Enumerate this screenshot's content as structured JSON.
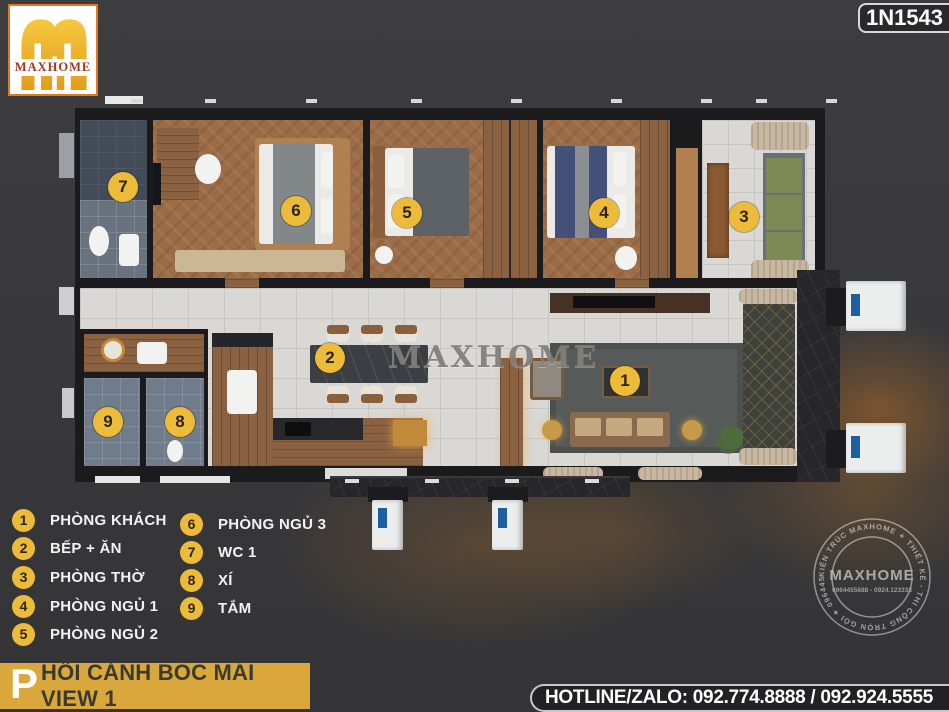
{
  "logo": {
    "text": "MAXHOME"
  },
  "badge": {
    "id": "1N1543"
  },
  "watermark": {
    "text": "MAXHOME"
  },
  "legend": {
    "items": [
      {
        "num": "1",
        "label": "PHÒNG KHÁCH"
      },
      {
        "num": "2",
        "label": "BẾP + ĂN"
      },
      {
        "num": "3",
        "label": "PHÒNG THỜ"
      },
      {
        "num": "4",
        "label": "PHÒNG NGỦ 1"
      },
      {
        "num": "5",
        "label": "PHÒNG NGỦ 2"
      },
      {
        "num": "6",
        "label": "PHÒNG NGỦ 3"
      },
      {
        "num": "7",
        "label": "WC 1"
      },
      {
        "num": "8",
        "label": "XÍ"
      },
      {
        "num": "9",
        "label": "TẮM"
      }
    ]
  },
  "footer": {
    "title_initial": "P",
    "title_rest": "HỐI CẢNH BÓC MÁI VIEW 1",
    "hotline": "HOTLINE/ZALO: 092.774.8888 / 092.924.5555"
  },
  "seal": {
    "ring": "KIẾN TRÚC MAXHOME ✦ THIẾT KẾ - THI CÔNG TRỌN GÓI ✦ 0964455888 ✦",
    "center": "MAXHOME",
    "phones": "0964455888 - 0924.123333"
  },
  "theme": {
    "background": "#3A3A3C",
    "marker_gold": "#ECBB3A",
    "banner_gold": "#D9A73C",
    "logo_orange": "#E0791F",
    "logo_maroon": "#9C3A22",
    "ac_label_blue": "#1D5FA0"
  }
}
